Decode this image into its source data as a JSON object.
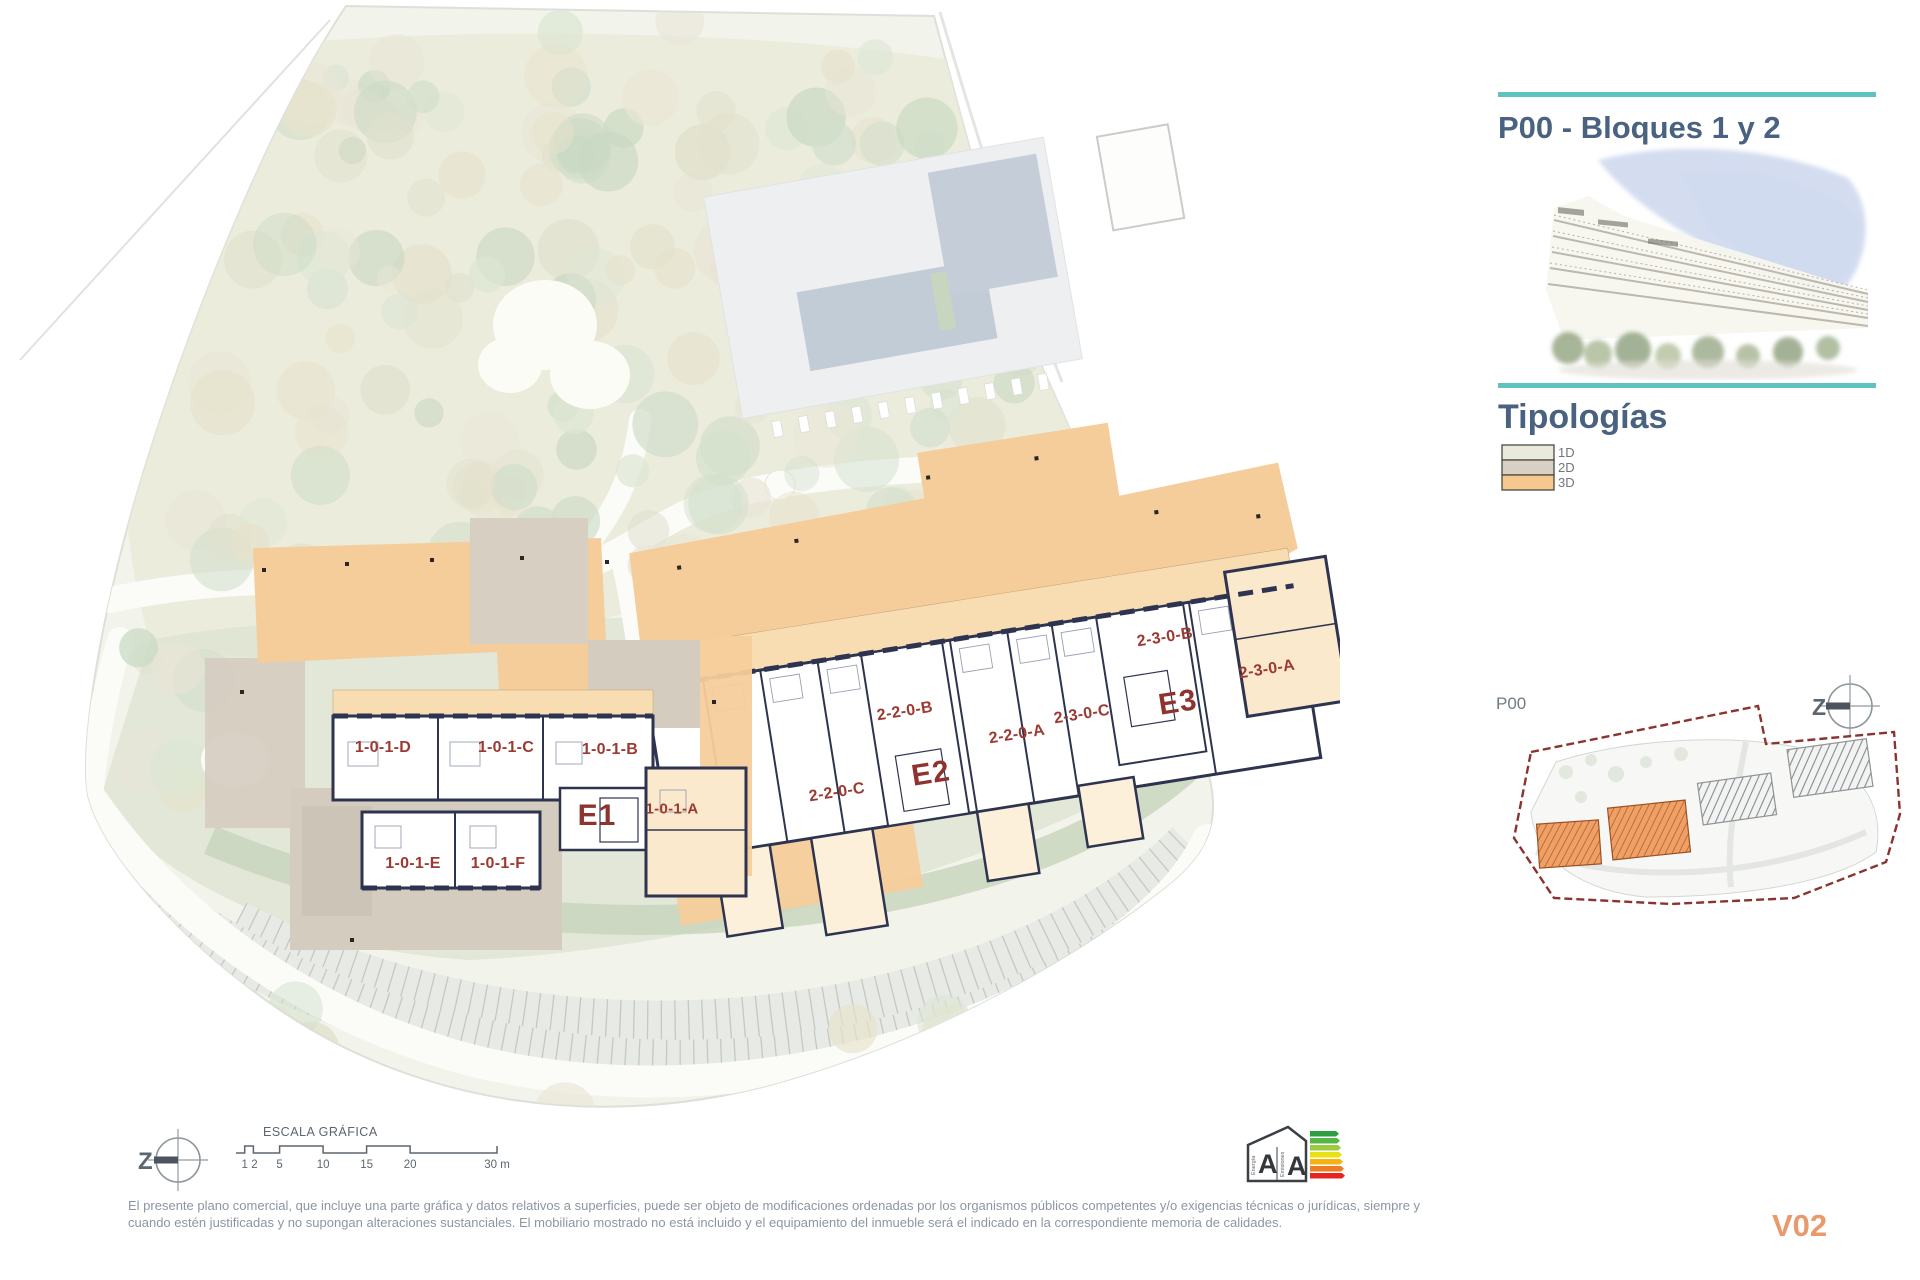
{
  "theme": {
    "accent_teal": "#5fc2bd",
    "heading_color": "#48627f",
    "unit_label_color": "#9c3a31",
    "block_label_color": "#8e332d",
    "version_color": "#e9996b",
    "disclaimer_color": "#8c96a3",
    "plan_orange": "#f5cd9b",
    "plan_taupe": "#d5ccc0",
    "wall_color": "#2e3450"
  },
  "header": {
    "title": "P00 - Bloques 1 y 2"
  },
  "typologies": {
    "title": "Tipologías",
    "items": [
      {
        "label": "1D",
        "color": "#e9e9dc"
      },
      {
        "label": "2D",
        "color": "#d8d0c4"
      },
      {
        "label": "3D",
        "color": "#f6c88f"
      }
    ]
  },
  "keymap": {
    "label": "P00"
  },
  "compass": {
    "letter": "Z"
  },
  "plan": {
    "unit_labels": [
      "1-0-1-D",
      "1-0-1-C",
      "1-0-1-B",
      "1-0-1-A",
      "E1",
      "1-0-1-E",
      "1-0-1-F",
      "2-2-0-C",
      "2-2-0-B",
      "2-2-0-A",
      "E2",
      "2-3-0-C",
      "2-3-0-B",
      "E3",
      "2-3-0-A"
    ]
  },
  "scalebar": {
    "title": "ESCALA GRÁFICA",
    "ticks": [
      "1",
      "2",
      "5",
      "10",
      "15",
      "20",
      "30 m"
    ]
  },
  "energy": {
    "letters": [
      "A",
      "A"
    ],
    "scales": [
      "Energía",
      "Emisiones"
    ],
    "bar_colors": [
      "#2e9e41",
      "#57b447",
      "#9ccb3b",
      "#e9e118",
      "#f5b211",
      "#ef7d23",
      "#e52521"
    ]
  },
  "footer": {
    "disclaimer_line1": "El presente plano comercial, que incluye una parte gráfica y datos relativos a superficies, puede ser objeto de modificaciones ordenadas por los organismos públicos competentes y/o exigencias técnicas o jurídicas, siempre y",
    "disclaimer_line2": "cuando estén justificadas y no supongan alteraciones sustanciales. El mobiliario mostrado no está incluido y el equipamiento del inmueble será el indicado en la correspondiente memoria de calidades.",
    "version": "V02"
  }
}
